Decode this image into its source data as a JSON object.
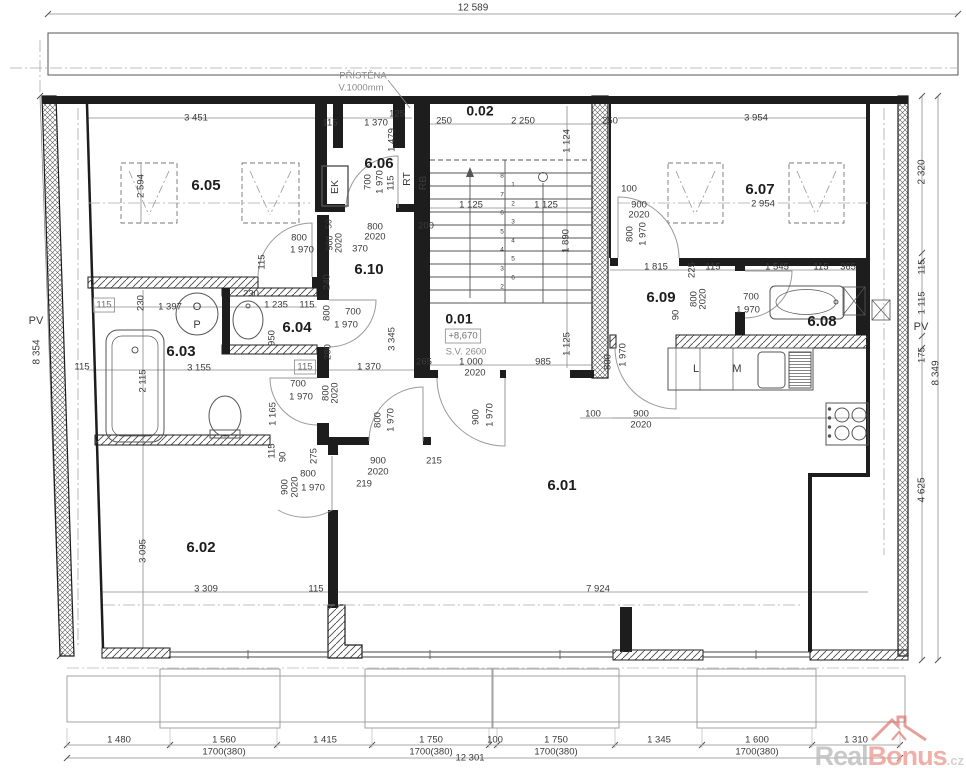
{
  "colors": {
    "line": "#1d1d1d",
    "dim_text": "#3a3a3a",
    "gray_text": "#8a8a8a",
    "watermark_red": "#ec9d94",
    "watermark_gray": "#bcbcbc"
  },
  "watermark": {
    "real": "Real",
    "bonus": "Bonus",
    "tld": ".cz"
  },
  "plan": {
    "rooms": [
      "0.01",
      "0.02",
      "6.01",
      "6.02",
      "6.03",
      "6.04",
      "6.05",
      "6.06",
      "6.07",
      "6.08",
      "6.09",
      "6.10"
    ],
    "stair_info": {
      "level": "+8,670",
      "clear_height": "S.V. 2600"
    },
    "note": {
      "line1": "PŘÍSTĚNA",
      "line2": "V.1000mm"
    },
    "overall": {
      "top": "12 589",
      "bottom": "12 301",
      "left": "8 354",
      "right": "8 349"
    },
    "labels": [
      {
        "t": "12 589",
        "x": 473,
        "y": 8,
        "s": 10
      },
      {
        "t": "PŘÍSTĚNA",
        "x": 363,
        "y": 76,
        "c": "g"
      },
      {
        "t": "V.1000mm",
        "x": 361,
        "y": 88,
        "c": "g"
      },
      {
        "t": "3 451",
        "x": 196,
        "y": 118
      },
      {
        "t": "115",
        "x": 330,
        "y": 123
      },
      {
        "t": "1 370",
        "x": 376,
        "y": 123
      },
      {
        "t": "125",
        "x": 397,
        "y": 114
      },
      {
        "t": "250",
        "x": 444,
        "y": 121
      },
      {
        "t": "2 250",
        "x": 523,
        "y": 121
      },
      {
        "t": "250",
        "x": 610,
        "y": 121
      },
      {
        "t": "3 954",
        "x": 756,
        "y": 118
      },
      {
        "t": "1 479",
        "x": 392,
        "y": 140,
        "r": -90
      },
      {
        "t": "1 124",
        "x": 567,
        "y": 141,
        "r": -90
      },
      {
        "t": "2 594",
        "x": 141,
        "y": 186,
        "r": -90
      },
      {
        "t": "6.05",
        "x": 206,
        "y": 186,
        "s": 15,
        "w": 1,
        "n": "room-label-6-05"
      },
      {
        "t": "6.06",
        "x": 379,
        "y": 164,
        "s": 15,
        "w": 1,
        "n": "room-label-6-06"
      },
      {
        "t": "6.07",
        "x": 760,
        "y": 190,
        "s": 15,
        "w": 1,
        "n": "room-label-6-07"
      },
      {
        "t": "0.02",
        "x": 480,
        "y": 112,
        "s": 14,
        "w": 1,
        "n": "room-label-0-02"
      },
      {
        "t": "0.01",
        "x": 459,
        "y": 320,
        "s": 14,
        "w": 1,
        "n": "room-label-0-01"
      },
      {
        "t": "6.10",
        "x": 369,
        "y": 270,
        "s": 15,
        "w": 1,
        "n": "room-label-6-10"
      },
      {
        "t": "6.04",
        "x": 297,
        "y": 328,
        "s": 15,
        "w": 1,
        "n": "room-label-6-04"
      },
      {
        "t": "6.03",
        "x": 181,
        "y": 352,
        "s": 15,
        "w": 1,
        "n": "room-label-6-03"
      },
      {
        "t": "6.09",
        "x": 661,
        "y": 298,
        "s": 15,
        "w": 1,
        "n": "room-label-6-09"
      },
      {
        "t": "6.08",
        "x": 822,
        "y": 322,
        "s": 15,
        "w": 1,
        "n": "room-label-6-08"
      },
      {
        "t": "6.02",
        "x": 201,
        "y": 548,
        "s": 15,
        "w": 1,
        "n": "room-label-6-02"
      },
      {
        "t": "6.01",
        "x": 562,
        "y": 486,
        "s": 15,
        "w": 1,
        "n": "room-label-6-01"
      },
      {
        "t": "+8,670",
        "x": 463,
        "y": 336,
        "c": "box",
        "n": "level-label"
      },
      {
        "t": "S.V. 2600",
        "x": 466,
        "y": 352,
        "c": "g",
        "n": "clear-height-label"
      },
      {
        "t": "EK",
        "x": 335,
        "y": 187,
        "r": -90,
        "s": 10.5
      },
      {
        "t": "RT",
        "x": 407,
        "y": 179,
        "r": -90,
        "s": 10.5
      },
      {
        "t": "RB",
        "x": 423,
        "y": 183,
        "r": -90,
        "s": 10.5
      },
      {
        "t": "O",
        "x": 197,
        "y": 307,
        "s": 11
      },
      {
        "t": "P",
        "x": 197,
        "y": 325,
        "s": 11
      },
      {
        "t": "L",
        "x": 696,
        "y": 369,
        "s": 11
      },
      {
        "t": "M",
        "x": 737,
        "y": 369,
        "s": 11
      },
      {
        "t": "PV",
        "x": 36,
        "y": 321,
        "s": 11
      },
      {
        "t": "PV",
        "x": 921,
        "y": 327,
        "s": 11
      },
      {
        "t": "800",
        "x": 299,
        "y": 238
      },
      {
        "t": "1 970",
        "x": 302,
        "y": 250
      },
      {
        "t": "115",
        "x": 262,
        "y": 262,
        "r": -90
      },
      {
        "t": "700",
        "x": 368,
        "y": 182,
        "r": -90
      },
      {
        "t": "1 970",
        "x": 380,
        "y": 182,
        "r": -90
      },
      {
        "t": "115",
        "x": 391,
        "y": 183,
        "r": -90
      },
      {
        "t": "50",
        "x": 329,
        "y": 224,
        "r": -90,
        "s": 8.5
      },
      {
        "t": "900",
        "x": 330,
        "y": 243,
        "r": -90,
        "s": 9
      },
      {
        "t": "2020",
        "x": 339,
        "y": 243,
        "r": -90,
        "s": 9
      },
      {
        "t": "800",
        "x": 375,
        "y": 227
      },
      {
        "t": "2020",
        "x": 375,
        "y": 237
      },
      {
        "t": "370",
        "x": 360,
        "y": 249
      },
      {
        "t": "200",
        "x": 426,
        "y": 226
      },
      {
        "t": "100",
        "x": 629,
        "y": 189
      },
      {
        "t": "900",
        "x": 639,
        "y": 205
      },
      {
        "t": "2020",
        "x": 639,
        "y": 215
      },
      {
        "t": "800",
        "x": 630,
        "y": 234,
        "r": -90
      },
      {
        "t": "1 970",
        "x": 643,
        "y": 234,
        "r": -90
      },
      {
        "t": "2 954",
        "x": 763,
        "y": 204
      },
      {
        "t": "240",
        "x": 327,
        "y": 282,
        "r": -90
      },
      {
        "t": "800",
        "x": 327,
        "y": 313,
        "r": -90
      },
      {
        "t": "700",
        "x": 353,
        "y": 312
      },
      {
        "t": "1 970",
        "x": 346,
        "y": 325
      },
      {
        "t": "280",
        "x": 328,
        "y": 352,
        "r": -90
      },
      {
        "t": "115",
        "x": 305,
        "y": 367,
        "c": "box"
      },
      {
        "t": "1 370",
        "x": 369,
        "y": 367
      },
      {
        "t": "3 345",
        "x": 392,
        "y": 339,
        "r": -90
      },
      {
        "t": "265",
        "x": 424,
        "y": 362
      },
      {
        "t": "115",
        "x": 104,
        "y": 305,
        "c": "box"
      },
      {
        "t": "230",
        "x": 141,
        "y": 303,
        "r": -90
      },
      {
        "t": "1 397",
        "x": 170,
        "y": 307
      },
      {
        "t": "230",
        "x": 251,
        "y": 294
      },
      {
        "t": "1 235",
        "x": 276,
        "y": 305
      },
      {
        "t": "115",
        "x": 307,
        "y": 305
      },
      {
        "t": "950",
        "x": 272,
        "y": 338,
        "r": -90
      },
      {
        "t": "115",
        "x": 82,
        "y": 367
      },
      {
        "t": "2 115",
        "x": 143,
        "y": 381,
        "r": -90
      },
      {
        "t": "3 155",
        "x": 199,
        "y": 368
      },
      {
        "t": "700",
        "x": 298,
        "y": 384
      },
      {
        "t": "1 970",
        "x": 301,
        "y": 397
      },
      {
        "t": "1 165",
        "x": 273,
        "y": 414,
        "r": -90
      },
      {
        "t": "800",
        "x": 326,
        "y": 393,
        "r": -90
      },
      {
        "t": "2020",
        "x": 335,
        "y": 393,
        "r": -90
      },
      {
        "t": "115",
        "x": 272,
        "y": 451,
        "r": -90
      },
      {
        "t": "90",
        "x": 283,
        "y": 457,
        "r": -90
      },
      {
        "t": "275",
        "x": 314,
        "y": 456,
        "r": -90
      },
      {
        "t": "900",
        "x": 285,
        "y": 487,
        "r": -90
      },
      {
        "t": "2020",
        "x": 295,
        "y": 487,
        "r": -90
      },
      {
        "t": "800",
        "x": 308,
        "y": 474
      },
      {
        "t": "1 970",
        "x": 313,
        "y": 488
      },
      {
        "t": "219",
        "x": 364,
        "y": 484
      },
      {
        "t": "900",
        "x": 378,
        "y": 461
      },
      {
        "t": "2020",
        "x": 378,
        "y": 472
      },
      {
        "t": "800",
        "x": 378,
        "y": 420,
        "r": -90
      },
      {
        "t": "1 970",
        "x": 391,
        "y": 420,
        "r": -90
      },
      {
        "t": "215",
        "x": 434,
        "y": 461
      },
      {
        "t": "3 095",
        "x": 143,
        "y": 551,
        "r": -90
      },
      {
        "t": "3 309",
        "x": 206,
        "y": 589
      },
      {
        "t": "115",
        "x": 316,
        "y": 589
      },
      {
        "t": "7 924",
        "x": 598,
        "y": 589
      },
      {
        "t": "1 000",
        "x": 471,
        "y": 362
      },
      {
        "t": "2020",
        "x": 475,
        "y": 373
      },
      {
        "t": "985",
        "x": 543,
        "y": 362
      },
      {
        "t": "1 125",
        "x": 567,
        "y": 344,
        "r": -90
      },
      {
        "t": "1 125",
        "x": 471,
        "y": 205
      },
      {
        "t": "1 125",
        "x": 546,
        "y": 205
      },
      {
        "t": "1 890",
        "x": 566,
        "y": 241,
        "r": -90
      },
      {
        "t": "900",
        "x": 476,
        "y": 417,
        "r": -90
      },
      {
        "t": "1 970",
        "x": 490,
        "y": 415,
        "r": -90
      },
      {
        "t": "100",
        "x": 593,
        "y": 414
      },
      {
        "t": "900",
        "x": 641,
        "y": 414
      },
      {
        "t": "2020",
        "x": 641,
        "y": 425
      },
      {
        "t": "800",
        "x": 608,
        "y": 362,
        "r": -90
      },
      {
        "t": "1 970",
        "x": 623,
        "y": 355,
        "r": -90
      },
      {
        "t": "1 815",
        "x": 656,
        "y": 267
      },
      {
        "t": "225",
        "x": 692,
        "y": 270,
        "r": -90
      },
      {
        "t": "115",
        "x": 713,
        "y": 267
      },
      {
        "t": "1 545",
        "x": 777,
        "y": 267
      },
      {
        "t": "115",
        "x": 821,
        "y": 267
      },
      {
        "t": "365",
        "x": 848,
        "y": 267
      },
      {
        "t": "90",
        "x": 676,
        "y": 315,
        "r": -90
      },
      {
        "t": "800",
        "x": 694,
        "y": 299,
        "r": -90
      },
      {
        "t": "2020",
        "x": 703,
        "y": 299,
        "r": -90
      },
      {
        "t": "700",
        "x": 751,
        "y": 297
      },
      {
        "t": "1 970",
        "x": 748,
        "y": 310
      },
      {
        "t": "2 320",
        "x": 922,
        "y": 172,
        "r": -90,
        "s": 10
      },
      {
        "t": "115",
        "x": 922,
        "y": 267,
        "r": -90
      },
      {
        "t": "1 115",
        "x": 922,
        "y": 303,
        "r": -90
      },
      {
        "t": "175",
        "x": 922,
        "y": 355,
        "r": -90
      },
      {
        "t": "8 349",
        "x": 936,
        "y": 373,
        "r": -90,
        "s": 10
      },
      {
        "t": "4 625",
        "x": 922,
        "y": 490,
        "r": -90,
        "s": 10
      },
      {
        "t": "8 354",
        "x": 37,
        "y": 352,
        "r": -90,
        "s": 10
      },
      {
        "t": "1 480",
        "x": 119,
        "y": 740
      },
      {
        "t": "1 560",
        "x": 224,
        "y": 740
      },
      {
        "t": "1700(380)",
        "x": 224,
        "y": 752
      },
      {
        "t": "1 415",
        "x": 325,
        "y": 740
      },
      {
        "t": "1 750",
        "x": 431,
        "y": 740
      },
      {
        "t": "1700(380)",
        "x": 431,
        "y": 752
      },
      {
        "t": "100",
        "x": 495,
        "y": 740
      },
      {
        "t": "1 750",
        "x": 556,
        "y": 740
      },
      {
        "t": "1700(380)",
        "x": 556,
        "y": 752
      },
      {
        "t": "1 345",
        "x": 659,
        "y": 740
      },
      {
        "t": "1 600",
        "x": 757,
        "y": 740
      },
      {
        "t": "1700(380)",
        "x": 757,
        "y": 752
      },
      {
        "t": "1 310",
        "x": 856,
        "y": 740
      },
      {
        "t": "12 301",
        "x": 470,
        "y": 758
      },
      {
        "t": "8",
        "x": 502,
        "y": 176,
        "s": 6.5,
        "n": "stair-tread-number"
      },
      {
        "t": "7",
        "x": 502,
        "y": 195,
        "s": 6.5,
        "n": "stair-tread-number"
      },
      {
        "t": "6",
        "x": 502,
        "y": 213,
        "s": 6.5,
        "n": "stair-tread-number"
      },
      {
        "t": "5",
        "x": 502,
        "y": 232,
        "s": 6.5,
        "n": "stair-tread-number"
      },
      {
        "t": "4",
        "x": 502,
        "y": 250,
        "s": 6.5,
        "n": "stair-tread-number"
      },
      {
        "t": "3",
        "x": 502,
        "y": 269,
        "s": 6.5,
        "n": "stair-tread-number"
      },
      {
        "t": "2",
        "x": 502,
        "y": 287,
        "s": 6.5,
        "n": "stair-tread-number"
      },
      {
        "t": "1",
        "x": 513,
        "y": 185,
        "s": 6.5,
        "n": "stair-tread-number"
      },
      {
        "t": "2",
        "x": 513,
        "y": 204,
        "s": 6.5,
        "n": "stair-tread-number"
      },
      {
        "t": "3",
        "x": 513,
        "y": 222,
        "s": 6.5,
        "n": "stair-tread-number"
      },
      {
        "t": "4",
        "x": 513,
        "y": 241,
        "s": 6.5,
        "n": "stair-tread-number"
      },
      {
        "t": "5",
        "x": 513,
        "y": 259,
        "s": 6.5,
        "n": "stair-tread-number"
      },
      {
        "t": "6",
        "x": 513,
        "y": 278,
        "s": 6.5,
        "n": "stair-tread-number"
      }
    ]
  }
}
